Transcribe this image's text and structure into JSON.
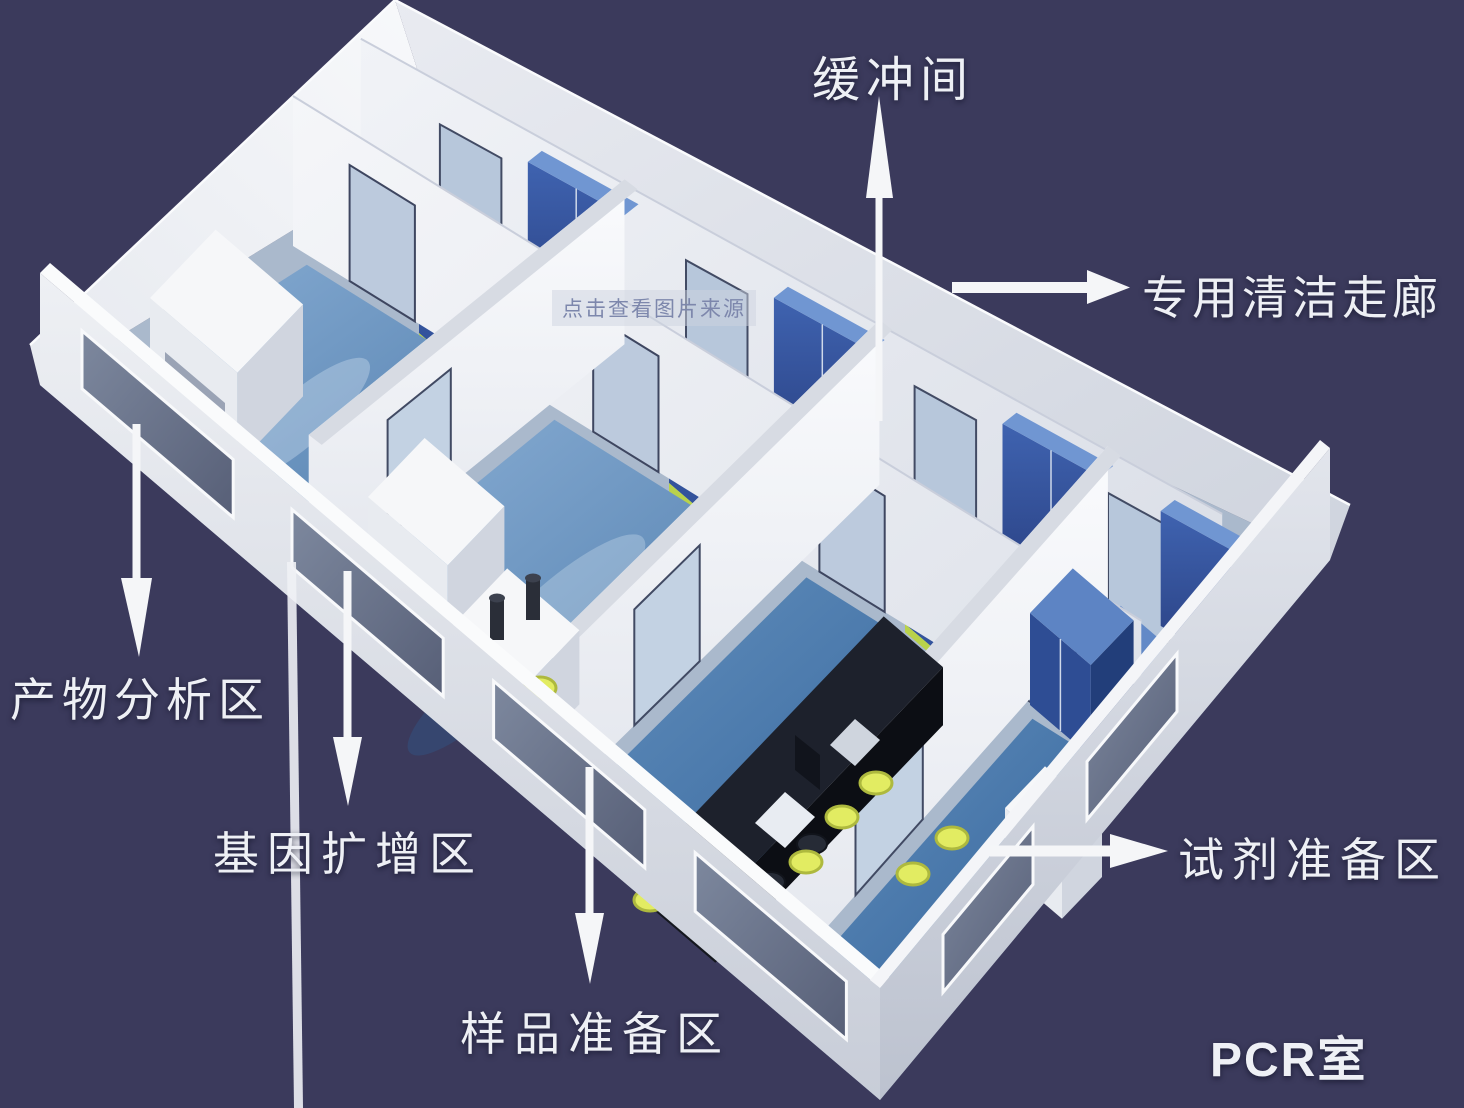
{
  "annotations": {
    "buffer_room": "缓冲间",
    "clean_corridor": "专用清洁走廊",
    "product_analysis": "产物分析区",
    "gene_amplification": "基因扩增区",
    "sample_preparation": "样品准备区",
    "reagent_preparation": "试剂准备区",
    "diagram_title": "PCR室"
  },
  "watermark": {
    "text": "点击查看图片来源"
  },
  "palette": {
    "background": "#3b3a5c",
    "wall_white": "#eef0f4",
    "floor_blue_light": "#7aa3cc",
    "floor_blue_dark": "#31629b",
    "cabinet_blue": "#2e4d94",
    "stool_yellow": "#e2ec62",
    "bench_black": "#15181f",
    "label_white": "#eef0f5",
    "lime_accent": "#b9d24b"
  }
}
